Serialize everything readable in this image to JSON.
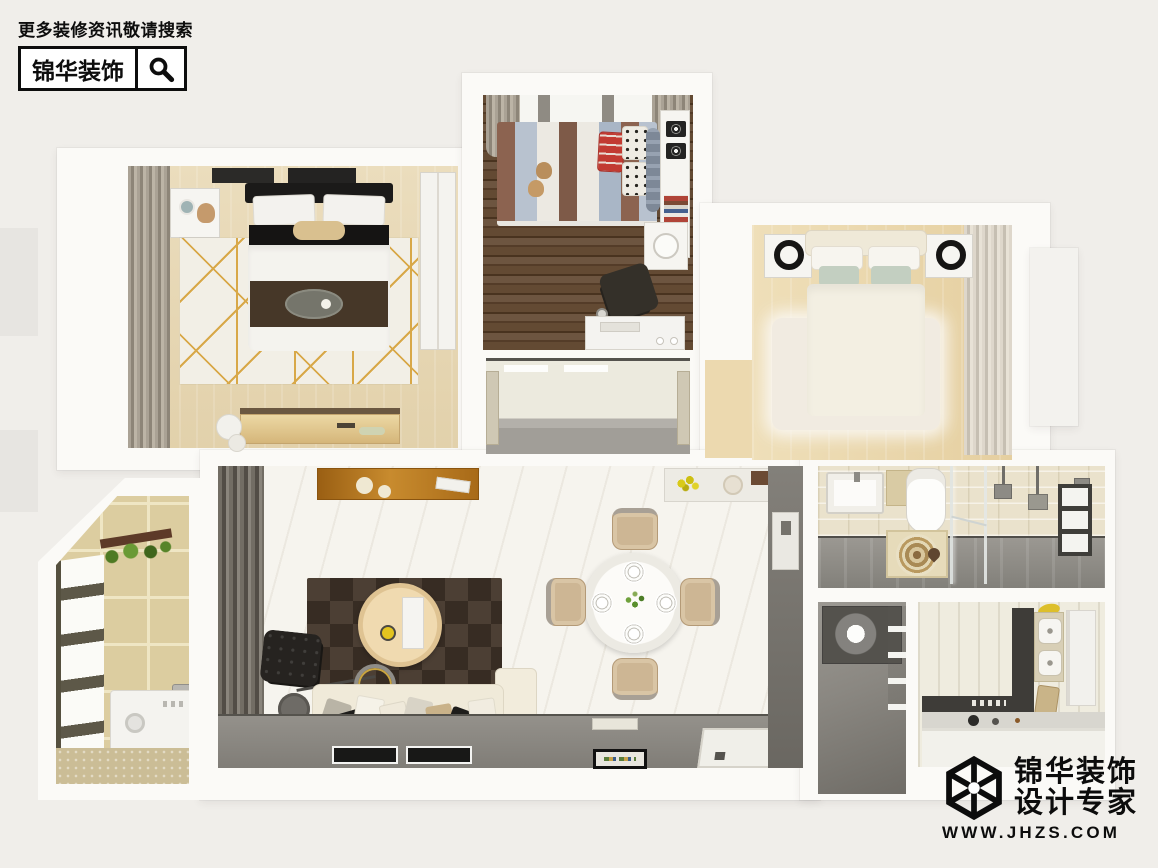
{
  "promo": {
    "search_hint": "更多装修资讯敬请搜索",
    "brand": "锦华装饰",
    "icon": "magnifier-icon"
  },
  "watermark": {
    "brand": "锦华装饰",
    "tagline": "设计专家",
    "url": "WWW.JHZS.COM",
    "icon": "cube-logo-icon"
  },
  "palette": {
    "page_bg": "#f0eeea",
    "wall_white": "#fbfaf7",
    "brand_black": "#0d0d0d",
    "wood_light": "#e8d9b7",
    "wood_dark": "#57402c",
    "tile_beige": "#dccda0",
    "floor_gray": "#8f8c86",
    "rug_dark": "#3a2f26",
    "accent_gold": "#d8a848",
    "sage_pillow": "#c3cfc1",
    "kids_blue": "#aab7c7",
    "kids_red": "#c23b32"
  }
}
